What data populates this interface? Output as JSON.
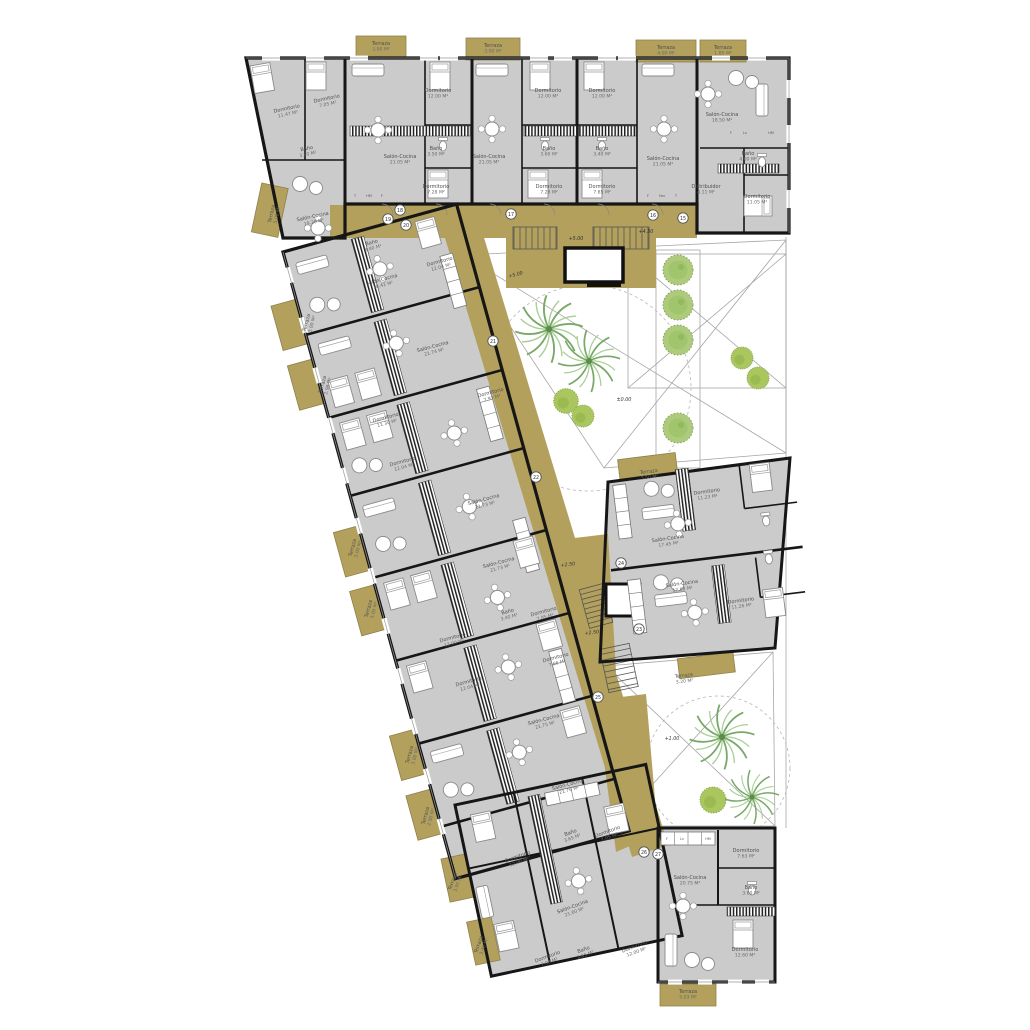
{
  "palette": {
    "room_fill": "#cbcbcb",
    "wall": "#161616",
    "walkway_tan": "#b2a05c",
    "tree_green": "#a9c97a",
    "palm_green": "#79a968",
    "thin_line": "#9a9a9a"
  },
  "rooms": [
    {
      "n": "Dormitorio",
      "a": "11.47 M²",
      "x": 287,
      "y": 110,
      "r": -12
    },
    {
      "n": "Dormitorio",
      "a": "7.05 M²",
      "x": 327,
      "y": 100,
      "r": -12
    },
    {
      "n": "Baño",
      "a": "3.50 M²",
      "x": 307,
      "y": 150,
      "r": -12
    },
    {
      "n": "Salón-Cocina",
      "a": "19.20 M²",
      "x": 313,
      "y": 218,
      "r": -12
    },
    {
      "n": "Salón-Cocina",
      "a": "21.05 M²",
      "x": 400,
      "y": 158,
      "r": 0
    },
    {
      "n": "Dormitorio",
      "a": "12.00 M²",
      "x": 438,
      "y": 92,
      "r": 0
    },
    {
      "n": "Baño",
      "a": "3.50 M²",
      "x": 436,
      "y": 150,
      "r": 0
    },
    {
      "n": "Dormitorio",
      "a": "7.28 M²",
      "x": 436,
      "y": 188,
      "r": 0
    },
    {
      "n": "Salón-Cocina",
      "a": "21.05 M²",
      "x": 489,
      "y": 158,
      "r": 0
    },
    {
      "n": "Dormitorio",
      "a": "12.00 M²",
      "x": 548,
      "y": 92,
      "r": 0
    },
    {
      "n": "Baño",
      "a": "3.60 M²",
      "x": 549,
      "y": 150,
      "r": 0
    },
    {
      "n": "Dormitorio",
      "a": "7.28 M²",
      "x": 549,
      "y": 188,
      "r": 0
    },
    {
      "n": "Dormitorio",
      "a": "12.00 M²",
      "x": 602,
      "y": 92,
      "r": 0
    },
    {
      "n": "Baño",
      "a": "3.40 M²",
      "x": 602,
      "y": 150,
      "r": 0
    },
    {
      "n": "Dormitorio",
      "a": "7.85 M²",
      "x": 602,
      "y": 188,
      "r": 0
    },
    {
      "n": "Salón-Cocina",
      "a": "21.05 M²",
      "x": 663,
      "y": 160,
      "r": 0
    },
    {
      "n": "Salón-Cocina",
      "a": "18.50 M²",
      "x": 722,
      "y": 116,
      "r": 0
    },
    {
      "n": "Baño",
      "a": "4.00 M²",
      "x": 748,
      "y": 155,
      "r": 0
    },
    {
      "n": "Distribuidor",
      "a": "4.11 M²",
      "x": 706,
      "y": 188,
      "r": 0
    },
    {
      "n": "Dormitorio",
      "a": "11.05 M²",
      "x": 757,
      "y": 198,
      "r": 0
    },
    {
      "n": "Salón-Cocina",
      "a": "18.42 M²",
      "x": 382,
      "y": 281,
      "r": -15
    },
    {
      "n": "Dormitorio",
      "a": "12.04 M²",
      "x": 440,
      "y": 263,
      "r": -15
    },
    {
      "n": "Baño",
      "a": "3.40 M²",
      "x": 372,
      "y": 244,
      "r": -15
    },
    {
      "n": "Salón-Cocina",
      "a": "21.74 M²",
      "x": 433,
      "y": 348,
      "r": -15
    },
    {
      "n": "Dormitorio",
      "a": "11.30 M²",
      "x": 386,
      "y": 419,
      "r": -15
    },
    {
      "n": "Dormitorio",
      "a": "7.93 M²",
      "x": 491,
      "y": 394,
      "r": -15
    },
    {
      "n": "Dormitorio",
      "a": "12.04 M²",
      "x": 403,
      "y": 463,
      "r": -15
    },
    {
      "n": "Salón-Cocina",
      "a": "21.73 M²",
      "x": 484,
      "y": 501,
      "r": -15
    },
    {
      "n": "Salón-Cocina",
      "a": "21.73 M²",
      "x": 499,
      "y": 564,
      "r": -15
    },
    {
      "n": "Dormitorio",
      "a": "12.00 M²",
      "x": 453,
      "y": 639,
      "r": -15
    },
    {
      "n": "Baño",
      "a": "3.40 M²",
      "x": 508,
      "y": 613,
      "r": -15
    },
    {
      "n": "Dormitorio",
      "a": "7.05 M²",
      "x": 544,
      "y": 613,
      "r": -15
    },
    {
      "n": "Dormitorio",
      "a": "12.04 M²",
      "x": 469,
      "y": 683,
      "r": -15
    },
    {
      "n": "Dormitorio",
      "a": "7.66 M²",
      "x": 556,
      "y": 659,
      "r": -15
    },
    {
      "n": "Salón-Cocina",
      "a": "21.75 M²",
      "x": 544,
      "y": 721,
      "r": -15
    },
    {
      "n": "Salón-Cocina",
      "a": "21.76 M²",
      "x": 568,
      "y": 786,
      "r": -15
    },
    {
      "n": "Dormitorio",
      "a": "12.00 M²",
      "x": 518,
      "y": 858,
      "r": -20
    },
    {
      "n": "Baño",
      "a": "3.65 M²",
      "x": 571,
      "y": 834,
      "r": -20
    },
    {
      "n": "Dormitorio",
      "a": "7.05 M²",
      "x": 608,
      "y": 833,
      "r": -20
    },
    {
      "n": "Salón-Cocina",
      "a": "21.60 M²",
      "x": 573,
      "y": 908,
      "r": -20
    },
    {
      "n": "Dormitorio",
      "a": "7.03 M²",
      "x": 548,
      "y": 958,
      "r": -20
    },
    {
      "n": "Baño",
      "a": "3.85 M²",
      "x": 584,
      "y": 951,
      "r": -20
    },
    {
      "n": "Dormitorio",
      "a": "12.00 M²",
      "x": 635,
      "y": 948,
      "r": -20
    },
    {
      "n": "Salón-Cocina",
      "a": "20.75 M²",
      "x": 690,
      "y": 879,
      "r": 0
    },
    {
      "n": "Dormitorio",
      "a": "7.63 M²",
      "x": 746,
      "y": 852,
      "r": 0
    },
    {
      "n": "Baño",
      "a": "3.60 M²",
      "x": 751,
      "y": 889,
      "r": 0
    },
    {
      "n": "Dormitorio",
      "a": "12.60 M²",
      "x": 745,
      "y": 951,
      "r": 0
    },
    {
      "n": "Salón-Cocina",
      "a": "17.45 M²",
      "x": 668,
      "y": 540,
      "r": -8
    },
    {
      "n": "Dormitorio",
      "a": "11.23 M²",
      "x": 707,
      "y": 493,
      "r": -8
    },
    {
      "n": "Salón-Cocina",
      "a": "17.68 M²",
      "x": 682,
      "y": 585,
      "r": -8
    },
    {
      "n": "Dormitorio",
      "a": "11.26 M²",
      "x": 741,
      "y": 602,
      "r": -8
    }
  ],
  "terraces": [
    {
      "n": "Terraza",
      "a": "3.00 M²",
      "x": 381,
      "y": 45,
      "r": 0
    },
    {
      "n": "Terraza",
      "a": "3.00 M²",
      "x": 493,
      "y": 47,
      "r": 0
    },
    {
      "n": "Terraza",
      "a": "4.00 M²",
      "x": 666,
      "y": 49,
      "r": 0
    },
    {
      "n": "Terraza",
      "a": "1.85 M²",
      "x": 723,
      "y": 49,
      "r": 0
    },
    {
      "n": "Terraza",
      "a": "5.00 M²",
      "x": 273,
      "y": 214,
      "r": -78
    },
    {
      "n": "Terraza",
      "a": "3.00 M²",
      "x": 308,
      "y": 323,
      "r": -75
    },
    {
      "n": "Terraza",
      "a": "2.98 M²",
      "x": 324,
      "y": 385,
      "r": -75
    },
    {
      "n": "Terraza",
      "a": "3.00 M²",
      "x": 354,
      "y": 548,
      "r": -75
    },
    {
      "n": "Terraza",
      "a": "3.00 M²",
      "x": 370,
      "y": 609,
      "r": -75
    },
    {
      "n": "Terraza",
      "a": "3.00 M²",
      "x": 411,
      "y": 755,
      "r": -75
    },
    {
      "n": "Terraza",
      "a": "2.90 M²",
      "x": 427,
      "y": 816,
      "r": -75
    },
    {
      "n": "Terraza",
      "a": "3.90 M²",
      "x": 454,
      "y": 882,
      "r": -70
    },
    {
      "n": "Terraza",
      "a": "3.40 M²",
      "x": 480,
      "y": 945,
      "r": -70
    },
    {
      "n": "Terraza",
      "a": "3.50 M²",
      "x": 649,
      "y": 473,
      "r": -7
    },
    {
      "n": "Terraza",
      "a": "3.20 M²",
      "x": 684,
      "y": 677,
      "r": -7
    },
    {
      "n": "Terraza",
      "a": "5.03 M²",
      "x": 688,
      "y": 993,
      "r": 0
    }
  ],
  "badges": [
    {
      "n": "15",
      "x": 683,
      "y": 218
    },
    {
      "n": "16",
      "x": 653,
      "y": 215
    },
    {
      "n": "17",
      "x": 511,
      "y": 214
    },
    {
      "n": "18",
      "x": 400,
      "y": 210
    },
    {
      "n": "19",
      "x": 388,
      "y": 219
    },
    {
      "n": "20",
      "x": 406,
      "y": 225
    },
    {
      "n": "21",
      "x": 493,
      "y": 341
    },
    {
      "n": "22",
      "x": 536,
      "y": 477
    },
    {
      "n": "23",
      "x": 639,
      "y": 629
    },
    {
      "n": "24",
      "x": 621,
      "y": 563
    },
    {
      "n": "25",
      "x": 598,
      "y": 697
    },
    {
      "n": "26",
      "x": 644,
      "y": 852
    },
    {
      "n": "27",
      "x": 658,
      "y": 854
    }
  ],
  "levels": [
    {
      "t": "+5.00",
      "x": 576,
      "y": 240,
      "r": 0
    },
    {
      "t": "+4.50",
      "x": 646,
      "y": 233,
      "r": 0
    },
    {
      "t": "+5.00",
      "x": 516,
      "y": 276,
      "r": -15
    },
    {
      "t": "±0.00",
      "x": 624,
      "y": 401,
      "r": 0
    },
    {
      "t": "+2.50",
      "x": 568,
      "y": 566,
      "r": -7
    },
    {
      "t": "+2.50",
      "x": 592,
      "y": 634,
      "r": -7
    },
    {
      "t": "+1.00",
      "x": 672,
      "y": 740,
      "r": 0
    }
  ],
  "kitchen_letters": [
    {
      "t": "T",
      "x": 355,
      "y": 197
    },
    {
      "t": "HM",
      "x": 369,
      "y": 197
    },
    {
      "t": "F",
      "x": 382,
      "y": 197
    },
    {
      "t": "F",
      "x": 648,
      "y": 197
    },
    {
      "t": "Hor",
      "x": 662,
      "y": 197
    },
    {
      "t": "T",
      "x": 676,
      "y": 197
    },
    {
      "t": "F",
      "x": 731,
      "y": 134
    },
    {
      "t": "Lv",
      "x": 745,
      "y": 134
    },
    {
      "t": "HM",
      "x": 771,
      "y": 134
    },
    {
      "t": "F",
      "x": 667,
      "y": 840
    },
    {
      "t": "Lv",
      "x": 682,
      "y": 840
    },
    {
      "t": "HM",
      "x": 708,
      "y": 840
    }
  ]
}
